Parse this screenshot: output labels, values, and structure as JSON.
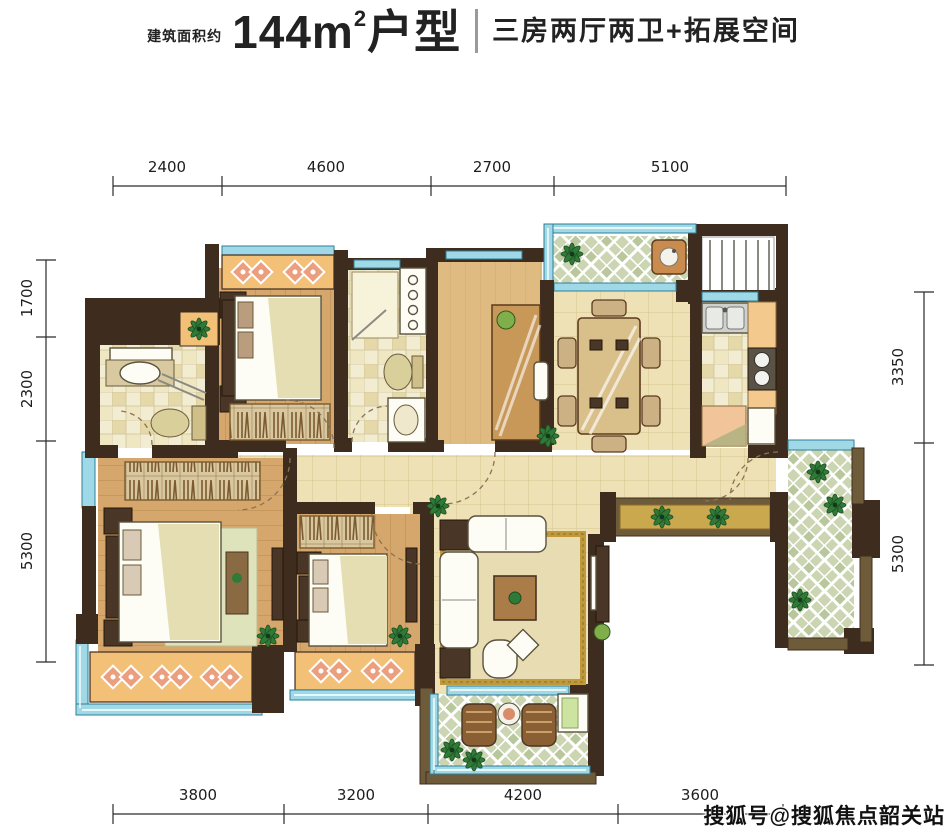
{
  "header": {
    "area_prefix": "建筑面积约",
    "area_value": "144m",
    "area_sup": "2",
    "area_suffix": "户型",
    "subtitle": "三房两厅两卫+拓展空间"
  },
  "dimensions": {
    "top": [
      "2400",
      "4600",
      "2700",
      "5100"
    ],
    "bottom": [
      "3800",
      "3200",
      "4200",
      "3600"
    ],
    "left": [
      "1700",
      "2300",
      "5300"
    ],
    "right": [
      "3350",
      "5300"
    ]
  },
  "watermark": "搜狐号@搜狐焦点韶关站",
  "plan": {
    "type": "apartment-floor-plan",
    "rooms": [
      "master-bathroom",
      "bedroom-north",
      "bathroom-2",
      "study",
      "dining-room",
      "kitchen",
      "equipment-platform",
      "north-balcony",
      "right-balcony",
      "entry-foyer",
      "planter",
      "master-bedroom",
      "bedroom-2",
      "living-room",
      "south-balcony"
    ],
    "colors": {
      "wall": "#3e2c1e",
      "balcony_wall": "#6d5b3a",
      "wood_floor": "#d6a76c",
      "tile_floor": "#eee1b5",
      "bath_tile": "#f2ecd2",
      "balcony_tile": "#dde3cb",
      "window": "#9fd8e6",
      "bay_accent": "#f2c077",
      "bay_diamond": "#eb9f7e",
      "rug_border": "#c09a3a",
      "plant": "#2f7a36"
    }
  }
}
